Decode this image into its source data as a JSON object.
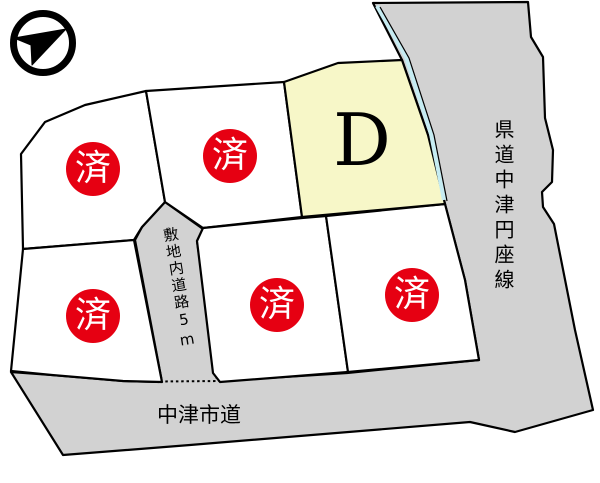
{
  "map": {
    "compass": {
      "icon_name": "north-arrow-icon"
    },
    "available_lot": {
      "label": "D"
    },
    "sold_stamp_label": "済",
    "sold_lot_count": 5,
    "road_labels": {
      "prefectural_road": "県道中津円座線",
      "city_road": "中津市道",
      "onsite_road": "敷地内道路5m"
    },
    "colors": {
      "road_fill": "#d2d2d2",
      "lot_fill": "#ffffff",
      "available_lot_fill": "#f7f7c8",
      "sold_stamp": "#e60012",
      "frontage_line": "#c6ecf2",
      "outline": "#000000"
    }
  }
}
